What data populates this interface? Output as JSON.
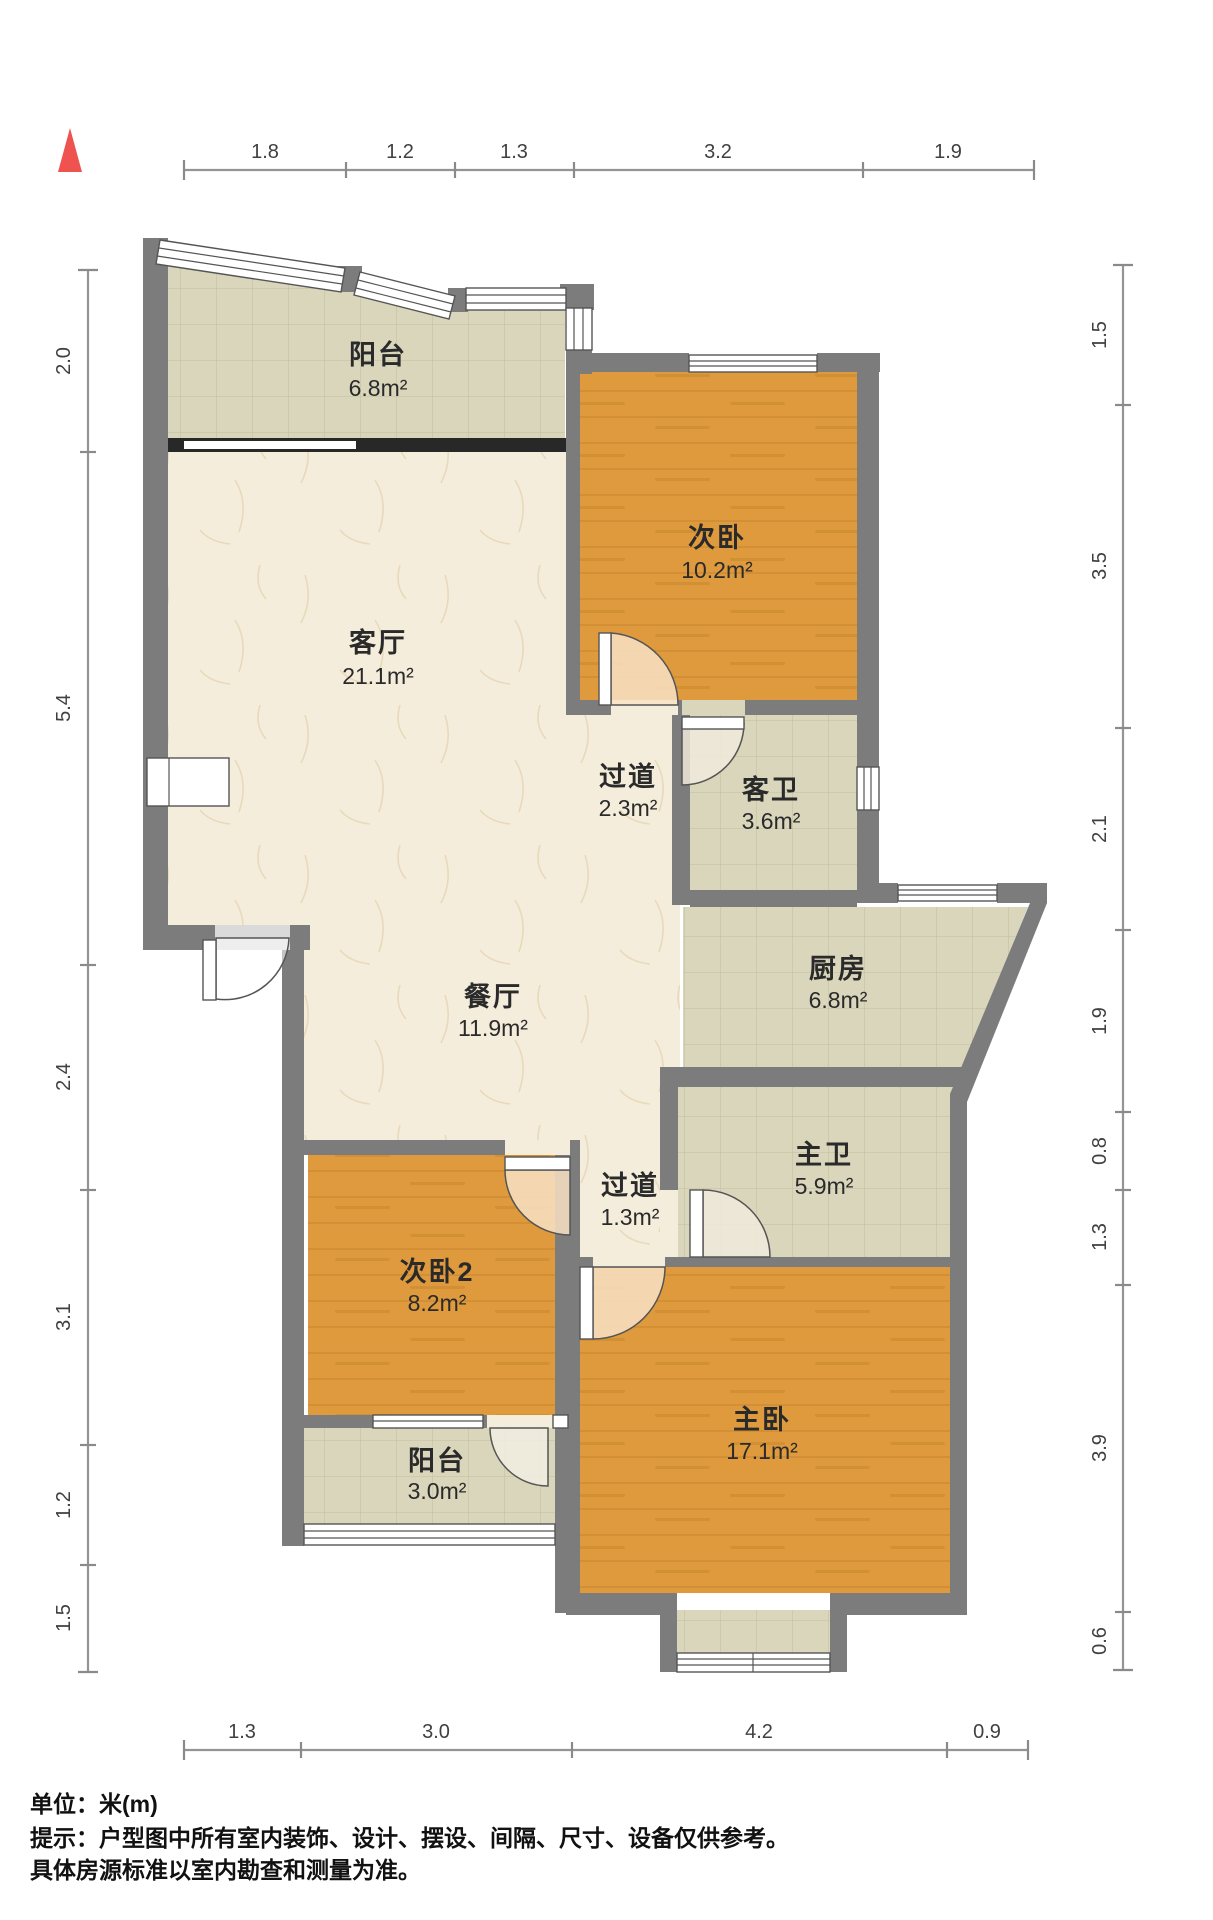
{
  "rooms": {
    "balcony_top": {
      "name": "阳台",
      "area": "6.8m²"
    },
    "bedroom1": {
      "name": "次卧",
      "area": "10.2m²"
    },
    "living": {
      "name": "客厅",
      "area": "21.1m²"
    },
    "hallway1": {
      "name": "过道",
      "area": "2.3m²"
    },
    "bath_guest": {
      "name": "客卫",
      "area": "3.6m²"
    },
    "kitchen": {
      "name": "厨房",
      "area": "6.8m²"
    },
    "dining": {
      "name": "餐厅",
      "area": "11.9m²"
    },
    "bath_master": {
      "name": "主卫",
      "area": "5.9m²"
    },
    "hallway2": {
      "name": "过道",
      "area": "1.3m²"
    },
    "bedroom2": {
      "name": "次卧2",
      "area": "8.2m²"
    },
    "master": {
      "name": "主卧",
      "area": "17.1m²"
    },
    "balcony_bottom": {
      "name": "阳台",
      "area": "3.0m²"
    }
  },
  "dimensions": {
    "top": [
      "1.8",
      "1.2",
      "1.3",
      "3.2",
      "1.9"
    ],
    "bottom": [
      "1.3",
      "3.0",
      "4.2",
      "0.9"
    ],
    "left": [
      "2.0",
      "5.4",
      "2.4",
      "3.1",
      "1.2",
      "1.5"
    ],
    "right": [
      "1.5",
      "3.5",
      "2.1",
      "1.9",
      "0.8",
      "1.3",
      "3.9",
      "0.6"
    ]
  },
  "notes": {
    "unit": "单位：米(m)",
    "tip_line1": "提示：户型图中所有室内装饰、设计、摆设、间隔、尺寸、设备仅供参考。",
    "tip_line2": "具体房源标准以室内勘查和测量为准。"
  },
  "colors": {
    "wall": "#7c7c7c",
    "wood_floor": "#df9a3e",
    "tile_floor": "#d9d6bc",
    "marble_floor": "#f5eddb",
    "north_arrow": "#ef5350",
    "dim_text": "#404040"
  }
}
